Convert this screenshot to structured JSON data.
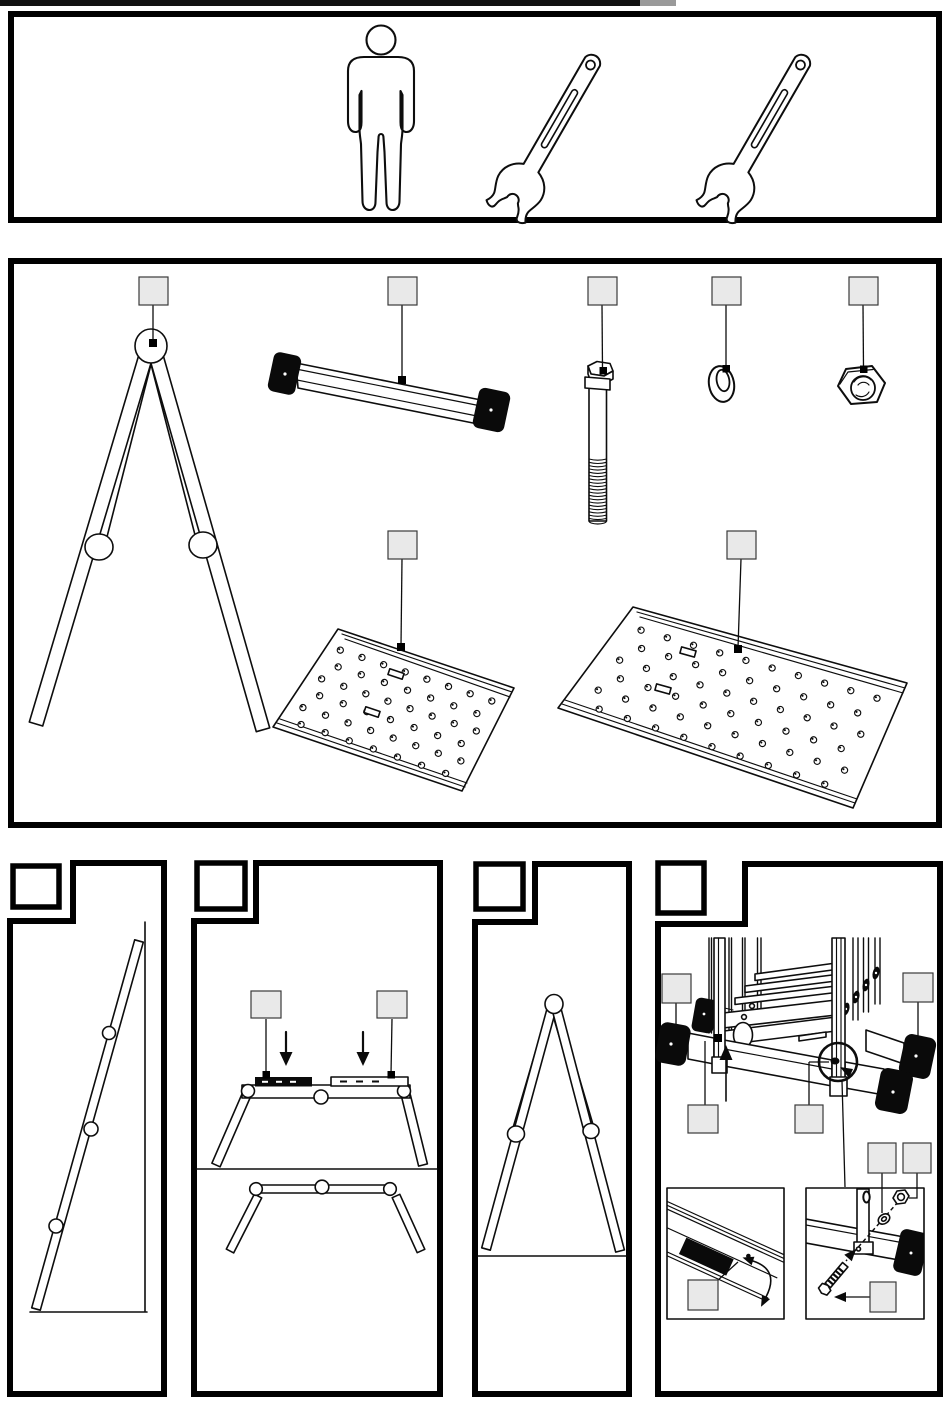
{
  "page": {
    "kind": "assembly-instruction-sheet",
    "width": 950,
    "height": 1402,
    "background": "#ffffff",
    "ink": "#000000",
    "callout_fill": "#e9e9e9",
    "scan_artifact_color": "#111111"
  },
  "top_panel": {
    "icons": [
      "person-icon",
      "open-end-wrench-icon",
      "open-end-wrench-icon"
    ],
    "person_count": 1,
    "wrench_count": 2
  },
  "parts_panel": {
    "callout_boxes_blank": true,
    "parts": [
      {
        "id": "trestle-a-frame",
        "callout_label": "",
        "hinge_circles": 3
      },
      {
        "id": "stabilizer-bar-with-end-caps",
        "callout_label": "",
        "end_caps": 2
      },
      {
        "id": "hex-bolt",
        "callout_label": "",
        "thread_lines": 19
      },
      {
        "id": "washer",
        "callout_label": ""
      },
      {
        "id": "hex-nut",
        "callout_label": ""
      },
      {
        "id": "platform-small",
        "callout_label": "",
        "holes": {
          "rows": 6,
          "cols_even": 8,
          "cols_odd": 7
        },
        "slot_count": 2
      },
      {
        "id": "platform-large",
        "callout_label": "",
        "holes": {
          "rows": 6,
          "cols_even": 10,
          "cols_odd": 9
        },
        "slot_count": 2
      }
    ]
  },
  "steps": [
    {
      "n": 1,
      "box_label": "",
      "shows": "single-rail-leaning-against-wall",
      "hinge_circles": 3
    },
    {
      "n": 2,
      "box_label": "",
      "shows": "place-two-bars-on-folded-trestle",
      "callout_boxes": 2,
      "down_arrows": 2
    },
    {
      "n": 3,
      "box_label": "",
      "shows": "opened-a-frame-standing-on-floor",
      "hinge_circles": 3
    },
    {
      "n": 4,
      "box_label": "",
      "shows": "attach-stabilizer-bars-with-bolt-washer-nut",
      "callout_boxes": 8,
      "end_caps": 4,
      "detail_insets": 2,
      "magnifier": true
    }
  ]
}
